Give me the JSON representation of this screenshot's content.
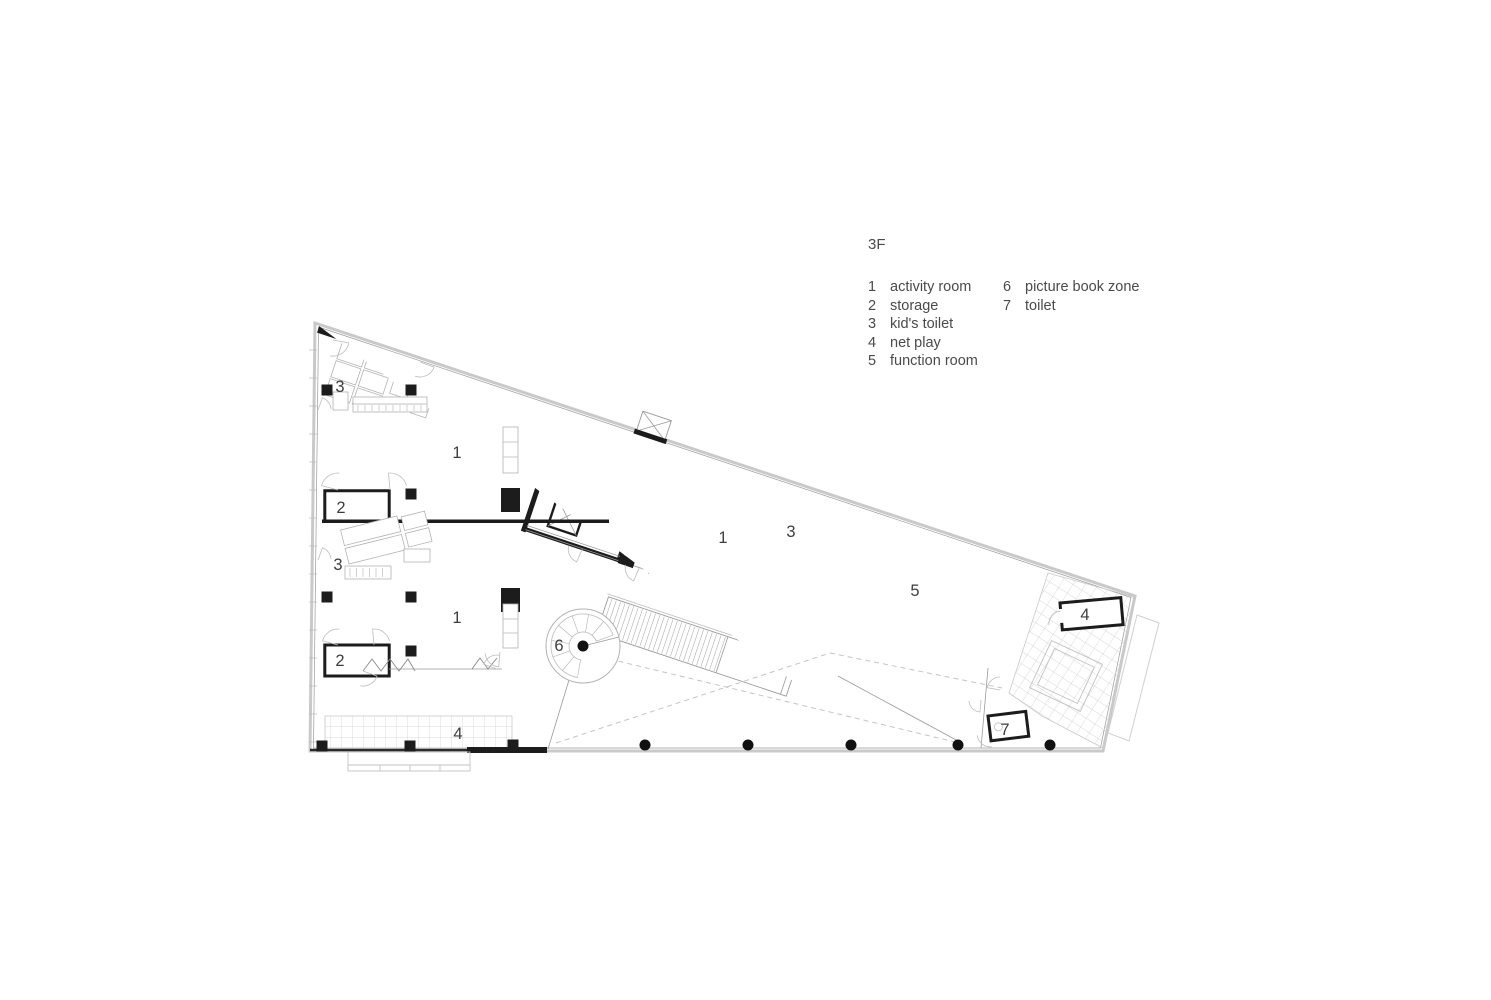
{
  "title": "3F",
  "legend": {
    "column1": [
      {
        "num": "1",
        "label": "activity room"
      },
      {
        "num": "2",
        "label": "storage"
      },
      {
        "num": "3",
        "label": "kid's toilet"
      },
      {
        "num": "4",
        "label": "net play"
      },
      {
        "num": "5",
        "label": "function room"
      }
    ],
    "column2": [
      {
        "num": "6",
        "label": "picture book zone"
      },
      {
        "num": "7",
        "label": "toilet"
      }
    ]
  },
  "plan": {
    "room_labels": [
      {
        "text": "3",
        "x": 340,
        "y": 392
      },
      {
        "text": "1",
        "x": 457,
        "y": 458
      },
      {
        "text": "2",
        "x": 341,
        "y": 513
      },
      {
        "text": "3",
        "x": 338,
        "y": 570
      },
      {
        "text": "1",
        "x": 457,
        "y": 623
      },
      {
        "text": "2",
        "x": 340,
        "y": 666
      },
      {
        "text": "4",
        "x": 458,
        "y": 739
      },
      {
        "text": "1",
        "x": 723,
        "y": 543
      },
      {
        "text": "3",
        "x": 791,
        "y": 537
      },
      {
        "text": "5",
        "x": 915,
        "y": 596
      },
      {
        "text": "4",
        "x": 1085,
        "y": 620
      },
      {
        "text": "6",
        "x": 559,
        "y": 651
      },
      {
        "text": "7",
        "x": 1005,
        "y": 735
      }
    ],
    "square_columns": [
      [
        327,
        390
      ],
      [
        411,
        390
      ],
      [
        411,
        494
      ],
      [
        327,
        597
      ],
      [
        411,
        597
      ],
      [
        411,
        651
      ],
      [
        322,
        746
      ],
      [
        410,
        746
      ],
      [
        513,
        745
      ]
    ],
    "bottom_column_xs": [
      645,
      748,
      851,
      958,
      1050
    ],
    "colors": {
      "wall": "#1c1c1c",
      "thin_line": "#9a9a9a",
      "glazing": "#c9c9c9",
      "hatch": "#cccccc",
      "label": "#3e3e3e"
    }
  }
}
